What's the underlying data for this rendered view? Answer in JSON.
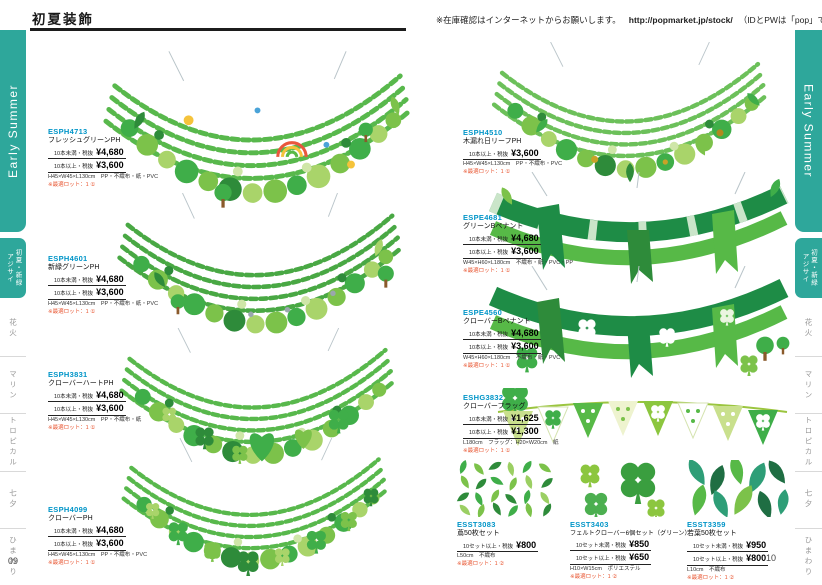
{
  "header": {
    "title": "初夏装飾",
    "stock_note": "※在庫確認はインターネットからお願いします。",
    "stock_url": "http://popmarket.jp/stock/",
    "stock_suffix": "（IDとPWは「pop」です）"
  },
  "footer": {
    "page_left": "09",
    "page_right": "10"
  },
  "colors": {
    "accent_teal": "#2ea79b",
    "code_blue": "#0095c8",
    "note_red": "#e8542f",
    "green_dark": "#2e8b3a",
    "green_mid": "#57b947",
    "green_light": "#8cc63f"
  },
  "sidebar": {
    "banner": "Early Summer",
    "tabs": [
      {
        "label_main": "初夏・新緑",
        "label_sub": "アジサイ",
        "active": true
      },
      {
        "label_main": "花火",
        "active": false
      },
      {
        "label_main": "マリン",
        "active": false
      },
      {
        "label_main": "トロピカル",
        "active": false
      },
      {
        "label_main": "七夕",
        "active": false
      },
      {
        "label_main": "ひまわり",
        "active": false
      }
    ]
  },
  "products_left": [
    {
      "code": "ESPH4713",
      "name": "フレッシュグリーンPH",
      "prices": [
        {
          "label": "10本未満・税抜",
          "value": "¥4,680"
        },
        {
          "label": "10本以上・税抜",
          "value": "¥3,600"
        }
      ],
      "spec": "H45×W45×L130cm　PP・不織布・紙・PVC",
      "note": "※最適ロット：1 ①"
    },
    {
      "code": "ESPH4601",
      "name": "新緑グリーンPH",
      "prices": [
        {
          "label": "10本未満・税抜",
          "value": "¥4,680"
        },
        {
          "label": "10本以上・税抜",
          "value": "¥3,600"
        }
      ],
      "spec": "H45×W45×L130cm　PP・不織布・紙・PVC",
      "note": "※最適ロット：1 ①"
    },
    {
      "code": "ESPH3831",
      "name": "クローバーハートPH",
      "prices": [
        {
          "label": "10本未満・税抜",
          "value": "¥4,680"
        },
        {
          "label": "10本以上・税抜",
          "value": "¥3,600"
        }
      ],
      "spec": "H45×W45×L130cm　PP・不織布・紙",
      "note": "※最適ロット：1 ①"
    },
    {
      "code": "ESPH4099",
      "name": "クローバーPH",
      "prices": [
        {
          "label": "10本未満・税抜",
          "value": "¥4,680"
        },
        {
          "label": "10本以上・税抜",
          "value": "¥3,600"
        }
      ],
      "spec": "H45×W45×L130cm　PP・不織布・PVC",
      "note": "※最適ロット：1 ①"
    }
  ],
  "products_right": [
    {
      "code": "ESPH4510",
      "name": "木漏れ日リーフPH",
      "prices": [
        {
          "label": "10本以上・税抜",
          "value": "¥3,600"
        }
      ],
      "spec": "H45×W45×L130cm　PP・不織布・PVC",
      "note": "※最適ロット：1 ①"
    },
    {
      "code": "ESPE4681",
      "name": "グリーンBペナント",
      "prices": [
        {
          "label": "10本未満・税抜",
          "value": "¥4,680"
        },
        {
          "label": "10本以上・税抜",
          "value": "¥3,600"
        }
      ],
      "spec": "W45×H60×L180cm　不織布・紙・PVC・PP",
      "note": "※最適ロット：1 ①"
    },
    {
      "code": "ESPE4560",
      "name": "クローバーBペナント",
      "prices": [
        {
          "label": "10本未満・税抜",
          "value": "¥4,680"
        },
        {
          "label": "10本以上・税抜",
          "value": "¥3,600"
        }
      ],
      "spec": "W45×H60×L180cm　不織布・紙・PVC",
      "note": "※最適ロット：1 ①"
    },
    {
      "code": "ESHG3832",
      "name": "クローバーフラッグ",
      "prices": [
        {
          "label": "10本未満・税抜",
          "value": "¥1,625"
        },
        {
          "label": "10本以上・税抜",
          "value": "¥1,300"
        }
      ],
      "spec": "L180cm　フラッグ：H20×W20cm　紙",
      "note": "※最適ロット：1 ①"
    },
    {
      "code": "ESST3083",
      "name": "蔦50枚セット",
      "prices": [
        {
          "label": "10セット以上・税抜",
          "value": "¥800"
        }
      ],
      "spec": "L50cm　不織布",
      "note": "※最適ロット：1 ②"
    },
    {
      "code": "ESST3403",
      "name": "フェルトクローバー6個セット（グリーン）",
      "prices": [
        {
          "label": "10セット未満・税抜",
          "value": "¥850"
        },
        {
          "label": "10セット以上・税抜",
          "value": "¥650"
        }
      ],
      "spec": "H10×W15cm　ポリエステル",
      "note": "※最適ロット：1 ②"
    },
    {
      "code": "ESST3359",
      "name": "若葉50枚セット",
      "prices": [
        {
          "label": "10セット未満・税抜",
          "value": "¥950"
        },
        {
          "label": "10セット以上・税抜",
          "value": "¥800"
        }
      ],
      "spec": "L10cm　不織布",
      "note": "※最適ロット：1 ②"
    }
  ]
}
